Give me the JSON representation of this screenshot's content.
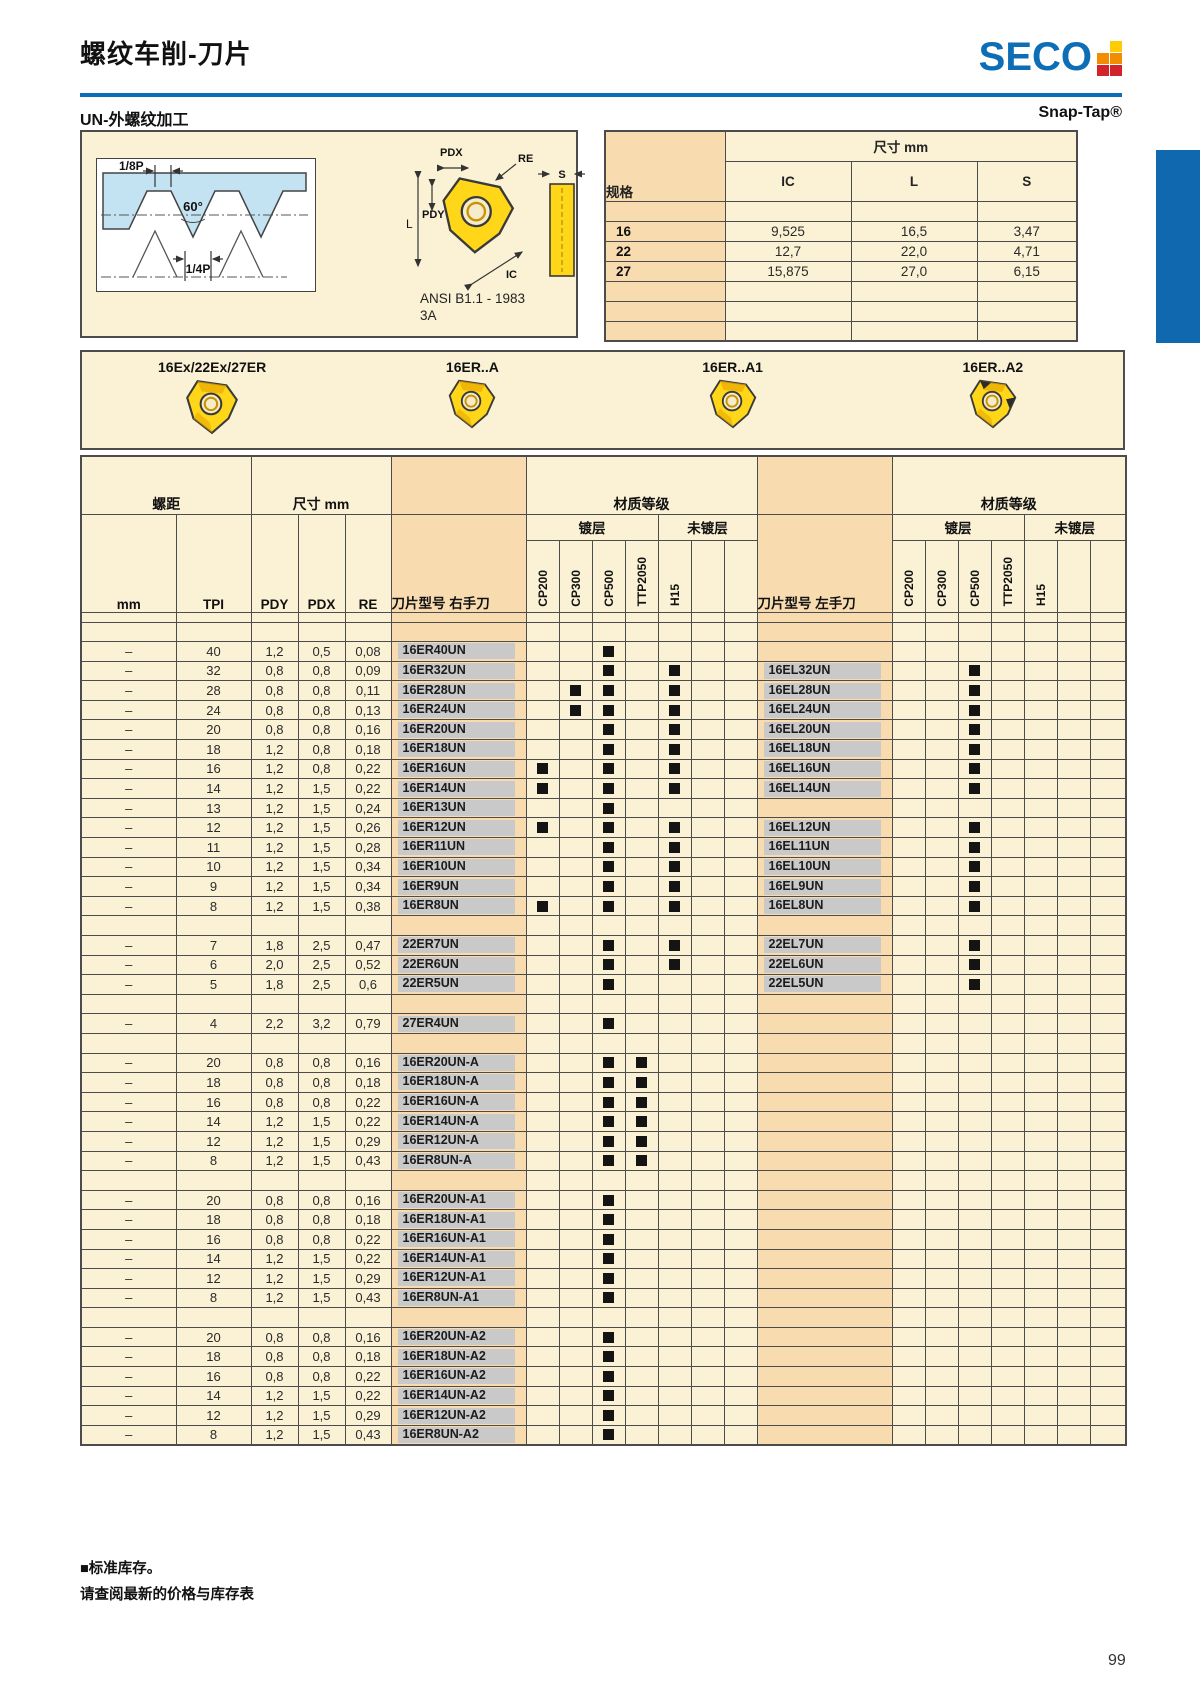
{
  "page": {
    "title": "螺纹车削-刀片",
    "brand": "SECO",
    "section_left": "UN-外螺纹加工",
    "section_right": "Snap-Tap®",
    "footnote_line1": "■标准库存。",
    "footnote_line2": "请查阅最新的价格与库存表",
    "page_number": "99",
    "colors": {
      "blue": "#0D6EB6",
      "cream": "#FBF2D5",
      "peach": "#F8DCB0",
      "insert_yellow": "#FFD718"
    }
  },
  "diagram": {
    "labels": {
      "p18": "1/8P",
      "angle": "60°",
      "p14": "1/4P",
      "pdx": "PDX",
      "pdy": "PDY",
      "re": "RE",
      "l": "L",
      "ic": "IC",
      "s": "S",
      "ansi": "ANSI B1.1 - 1983",
      "ansi2": "3A"
    }
  },
  "spec_table": {
    "col_spec": "规格",
    "size_header": "尺寸 mm",
    "cols": [
      "IC",
      "L",
      "S"
    ],
    "rows": [
      [
        "",
        "",
        "",
        ""
      ],
      [
        "16",
        "9,525",
        "16,5",
        "3,47"
      ],
      [
        "22",
        "12,7",
        "22,0",
        "4,71"
      ],
      [
        "27",
        "15,875",
        "27,0",
        "6,15"
      ],
      [
        "",
        "",
        "",
        ""
      ],
      [
        "",
        "",
        "",
        ""
      ],
      [
        "",
        "",
        "",
        ""
      ]
    ]
  },
  "inserts": [
    {
      "label": "16Ex/22Ex/27ER"
    },
    {
      "label": "16ER..A"
    },
    {
      "label": "16ER..A1"
    },
    {
      "label": "16ER..A2"
    }
  ],
  "main_table": {
    "headers": {
      "pitch": "螺距",
      "size": "尺寸 mm",
      "grade": "材质等级",
      "coated": "镀层",
      "uncoated": "未镀层",
      "mm": "mm",
      "tpi": "TPI",
      "pdy": "PDY",
      "pdx": "PDX",
      "re": "RE",
      "rh": "刀片型号 右手刀",
      "lh": "刀片型号 左手刀"
    },
    "grade_cols": [
      "CP200",
      "CP300",
      "CP500",
      "TTP2050",
      "H15",
      "",
      ""
    ],
    "rows": [
      {
        "sp": "thin"
      },
      {
        "sp": true
      },
      {
        "mm": "–",
        "tpi": "40",
        "pdy": "1,2",
        "pdx": "0,5",
        "re": "0,08",
        "rh": "16ER40UN",
        "rhg": [
          "CP500"
        ],
        "lh": "",
        "lhg": []
      },
      {
        "mm": "–",
        "tpi": "32",
        "pdy": "0,8",
        "pdx": "0,8",
        "re": "0,09",
        "rh": "16ER32UN",
        "rhg": [
          "CP500",
          "H15"
        ],
        "lh": "16EL32UN",
        "lhg": [
          "CP500"
        ]
      },
      {
        "mm": "–",
        "tpi": "28",
        "pdy": "0,8",
        "pdx": "0,8",
        "re": "0,11",
        "rh": "16ER28UN",
        "rhg": [
          "CP300",
          "CP500",
          "H15"
        ],
        "lh": "16EL28UN",
        "lhg": [
          "CP500"
        ]
      },
      {
        "mm": "–",
        "tpi": "24",
        "pdy": "0,8",
        "pdx": "0,8",
        "re": "0,13",
        "rh": "16ER24UN",
        "rhg": [
          "CP300",
          "CP500",
          "H15"
        ],
        "lh": "16EL24UN",
        "lhg": [
          "CP500"
        ]
      },
      {
        "mm": "–",
        "tpi": "20",
        "pdy": "0,8",
        "pdx": "0,8",
        "re": "0,16",
        "rh": "16ER20UN",
        "rhg": [
          "CP500",
          "H15"
        ],
        "lh": "16EL20UN",
        "lhg": [
          "CP500"
        ]
      },
      {
        "mm": "–",
        "tpi": "18",
        "pdy": "1,2",
        "pdx": "0,8",
        "re": "0,18",
        "rh": "16ER18UN",
        "rhg": [
          "CP500",
          "H15"
        ],
        "lh": "16EL18UN",
        "lhg": [
          "CP500"
        ]
      },
      {
        "mm": "–",
        "tpi": "16",
        "pdy": "1,2",
        "pdx": "0,8",
        "re": "0,22",
        "rh": "16ER16UN",
        "rhg": [
          "CP200",
          "CP500",
          "H15"
        ],
        "lh": "16EL16UN",
        "lhg": [
          "CP500"
        ]
      },
      {
        "mm": "–",
        "tpi": "14",
        "pdy": "1,2",
        "pdx": "1,5",
        "re": "0,22",
        "rh": "16ER14UN",
        "rhg": [
          "CP200",
          "CP500",
          "H15"
        ],
        "lh": "16EL14UN",
        "lhg": [
          "CP500"
        ]
      },
      {
        "mm": "–",
        "tpi": "13",
        "pdy": "1,2",
        "pdx": "1,5",
        "re": "0,24",
        "rh": "16ER13UN",
        "rhg": [
          "CP500"
        ],
        "lh": "",
        "lhg": []
      },
      {
        "mm": "–",
        "tpi": "12",
        "pdy": "1,2",
        "pdx": "1,5",
        "re": "0,26",
        "rh": "16ER12UN",
        "rhg": [
          "CP200",
          "CP500",
          "H15"
        ],
        "lh": "16EL12UN",
        "lhg": [
          "CP500"
        ]
      },
      {
        "mm": "–",
        "tpi": "11",
        "pdy": "1,2",
        "pdx": "1,5",
        "re": "0,28",
        "rh": "16ER11UN",
        "rhg": [
          "CP500",
          "H15"
        ],
        "lh": "16EL11UN",
        "lhg": [
          "CP500"
        ]
      },
      {
        "mm": "–",
        "tpi": "10",
        "pdy": "1,2",
        "pdx": "1,5",
        "re": "0,34",
        "rh": "16ER10UN",
        "rhg": [
          "CP500",
          "H15"
        ],
        "lh": "16EL10UN",
        "lhg": [
          "CP500"
        ]
      },
      {
        "mm": "–",
        "tpi": "9",
        "pdy": "1,2",
        "pdx": "1,5",
        "re": "0,34",
        "rh": "16ER9UN",
        "rhg": [
          "CP500",
          "H15"
        ],
        "lh": "16EL9UN",
        "lhg": [
          "CP500"
        ]
      },
      {
        "mm": "–",
        "tpi": "8",
        "pdy": "1,2",
        "pdx": "1,5",
        "re": "0,38",
        "rh": "16ER8UN",
        "rhg": [
          "CP200",
          "CP500",
          "H15"
        ],
        "lh": "16EL8UN",
        "lhg": [
          "CP500"
        ]
      },
      {
        "sp": true
      },
      {
        "mm": "–",
        "tpi": "7",
        "pdy": "1,8",
        "pdx": "2,5",
        "re": "0,47",
        "rh": "22ER7UN",
        "rhg": [
          "CP500",
          "H15"
        ],
        "lh": "22EL7UN",
        "lhg": [
          "CP500"
        ]
      },
      {
        "mm": "–",
        "tpi": "6",
        "pdy": "2,0",
        "pdx": "2,5",
        "re": "0,52",
        "rh": "22ER6UN",
        "rhg": [
          "CP500",
          "H15"
        ],
        "lh": "22EL6UN",
        "lhg": [
          "CP500"
        ]
      },
      {
        "mm": "–",
        "tpi": "5",
        "pdy": "1,8",
        "pdx": "2,5",
        "re": "0,6",
        "rh": "22ER5UN",
        "rhg": [
          "CP500"
        ],
        "lh": "22EL5UN",
        "lhg": [
          "CP500"
        ]
      },
      {
        "sp": true
      },
      {
        "mm": "–",
        "tpi": "4",
        "pdy": "2,2",
        "pdx": "3,2",
        "re": "0,79",
        "rh": "27ER4UN",
        "rhg": [
          "CP500"
        ],
        "lh": "",
        "lhg": []
      },
      {
        "sp": true
      },
      {
        "mm": "–",
        "tpi": "20",
        "pdy": "0,8",
        "pdx": "0,8",
        "re": "0,16",
        "rh": "16ER20UN-A",
        "rhg": [
          "CP500",
          "TTP2050"
        ],
        "lh": "",
        "lhg": []
      },
      {
        "mm": "–",
        "tpi": "18",
        "pdy": "0,8",
        "pdx": "0,8",
        "re": "0,18",
        "rh": "16ER18UN-A",
        "rhg": [
          "CP500",
          "TTP2050"
        ],
        "lh": "",
        "lhg": []
      },
      {
        "mm": "–",
        "tpi": "16",
        "pdy": "0,8",
        "pdx": "0,8",
        "re": "0,22",
        "rh": "16ER16UN-A",
        "rhg": [
          "CP500",
          "TTP2050"
        ],
        "lh": "",
        "lhg": []
      },
      {
        "mm": "–",
        "tpi": "14",
        "pdy": "1,2",
        "pdx": "1,5",
        "re": "0,22",
        "rh": "16ER14UN-A",
        "rhg": [
          "CP500",
          "TTP2050"
        ],
        "lh": "",
        "lhg": []
      },
      {
        "mm": "–",
        "tpi": "12",
        "pdy": "1,2",
        "pdx": "1,5",
        "re": "0,29",
        "rh": "16ER12UN-A",
        "rhg": [
          "CP500",
          "TTP2050"
        ],
        "lh": "",
        "lhg": []
      },
      {
        "mm": "–",
        "tpi": "8",
        "pdy": "1,2",
        "pdx": "1,5",
        "re": "0,43",
        "rh": "16ER8UN-A",
        "rhg": [
          "CP500",
          "TTP2050"
        ],
        "lh": "",
        "lhg": []
      },
      {
        "sp": true
      },
      {
        "mm": "–",
        "tpi": "20",
        "pdy": "0,8",
        "pdx": "0,8",
        "re": "0,16",
        "rh": "16ER20UN-A1",
        "rhg": [
          "CP500"
        ],
        "lh": "",
        "lhg": []
      },
      {
        "mm": "–",
        "tpi": "18",
        "pdy": "0,8",
        "pdx": "0,8",
        "re": "0,18",
        "rh": "16ER18UN-A1",
        "rhg": [
          "CP500"
        ],
        "lh": "",
        "lhg": []
      },
      {
        "mm": "–",
        "tpi": "16",
        "pdy": "0,8",
        "pdx": "0,8",
        "re": "0,22",
        "rh": "16ER16UN-A1",
        "rhg": [
          "CP500"
        ],
        "lh": "",
        "lhg": []
      },
      {
        "mm": "–",
        "tpi": "14",
        "pdy": "1,2",
        "pdx": "1,5",
        "re": "0,22",
        "rh": "16ER14UN-A1",
        "rhg": [
          "CP500"
        ],
        "lh": "",
        "lhg": []
      },
      {
        "mm": "–",
        "tpi": "12",
        "pdy": "1,2",
        "pdx": "1,5",
        "re": "0,29",
        "rh": "16ER12UN-A1",
        "rhg": [
          "CP500"
        ],
        "lh": "",
        "lhg": []
      },
      {
        "mm": "–",
        "tpi": "8",
        "pdy": "1,2",
        "pdx": "1,5",
        "re": "0,43",
        "rh": "16ER8UN-A1",
        "rhg": [
          "CP500"
        ],
        "lh": "",
        "lhg": []
      },
      {
        "sp": true
      },
      {
        "mm": "–",
        "tpi": "20",
        "pdy": "0,8",
        "pdx": "0,8",
        "re": "0,16",
        "rh": "16ER20UN-A2",
        "rhg": [
          "CP500"
        ],
        "lh": "",
        "lhg": []
      },
      {
        "mm": "–",
        "tpi": "18",
        "pdy": "0,8",
        "pdx": "0,8",
        "re": "0,18",
        "rh": "16ER18UN-A2",
        "rhg": [
          "CP500"
        ],
        "lh": "",
        "lhg": []
      },
      {
        "mm": "–",
        "tpi": "16",
        "pdy": "0,8",
        "pdx": "0,8",
        "re": "0,22",
        "rh": "16ER16UN-A2",
        "rhg": [
          "CP500"
        ],
        "lh": "",
        "lhg": []
      },
      {
        "mm": "–",
        "tpi": "14",
        "pdy": "1,2",
        "pdx": "1,5",
        "re": "0,22",
        "rh": "16ER14UN-A2",
        "rhg": [
          "CP500"
        ],
        "lh": "",
        "lhg": []
      },
      {
        "mm": "–",
        "tpi": "12",
        "pdy": "1,2",
        "pdx": "1,5",
        "re": "0,29",
        "rh": "16ER12UN-A2",
        "rhg": [
          "CP500"
        ],
        "lh": "",
        "lhg": []
      },
      {
        "mm": "–",
        "tpi": "8",
        "pdy": "1,2",
        "pdx": "1,5",
        "re": "0,43",
        "rh": "16ER8UN-A2",
        "rhg": [
          "CP500"
        ],
        "lh": "",
        "lhg": []
      }
    ]
  }
}
